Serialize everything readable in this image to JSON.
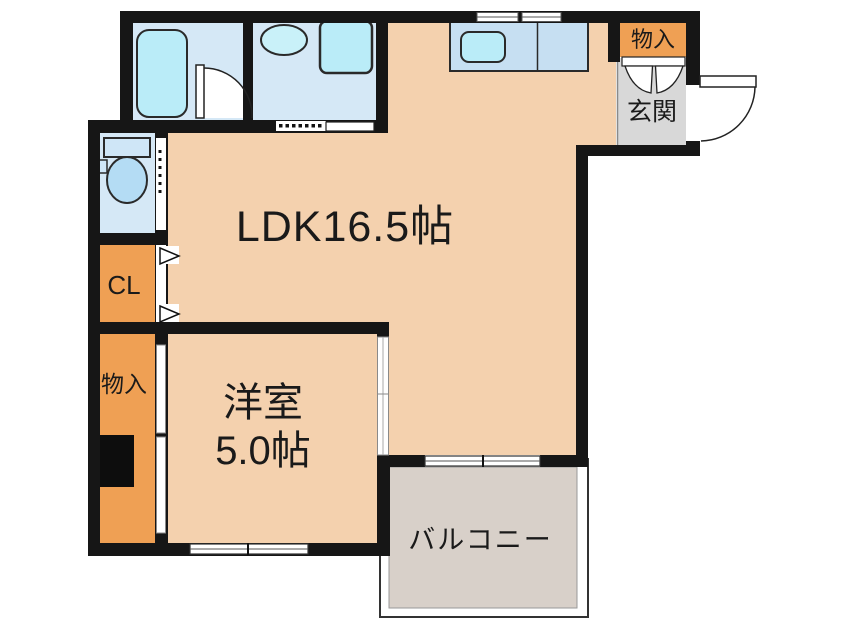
{
  "plan": {
    "rooms": {
      "ldk": {
        "label": "LDK16.5帖"
      },
      "western_room": {
        "name": "洋室",
        "area": "5.0帖"
      },
      "balcony": {
        "label": "バルコニー"
      },
      "entrance": {
        "label": "玄関"
      },
      "storage_upper": {
        "label": "物入"
      },
      "storage_lower": {
        "label": "物入"
      },
      "closet": {
        "label": "CL"
      }
    },
    "colors": {
      "wall": "#161616",
      "room_floor": "#f4d1ae",
      "storage_floor": "#efa054",
      "wet_area_floor": "#d5e8f6",
      "fixture_fill": "#baecf8",
      "kitchen_counter": "#c6dff2",
      "entrance_floor": "#d8d8d8",
      "balcony_floor": "#d8d0c9",
      "background": "#ffffff"
    }
  }
}
